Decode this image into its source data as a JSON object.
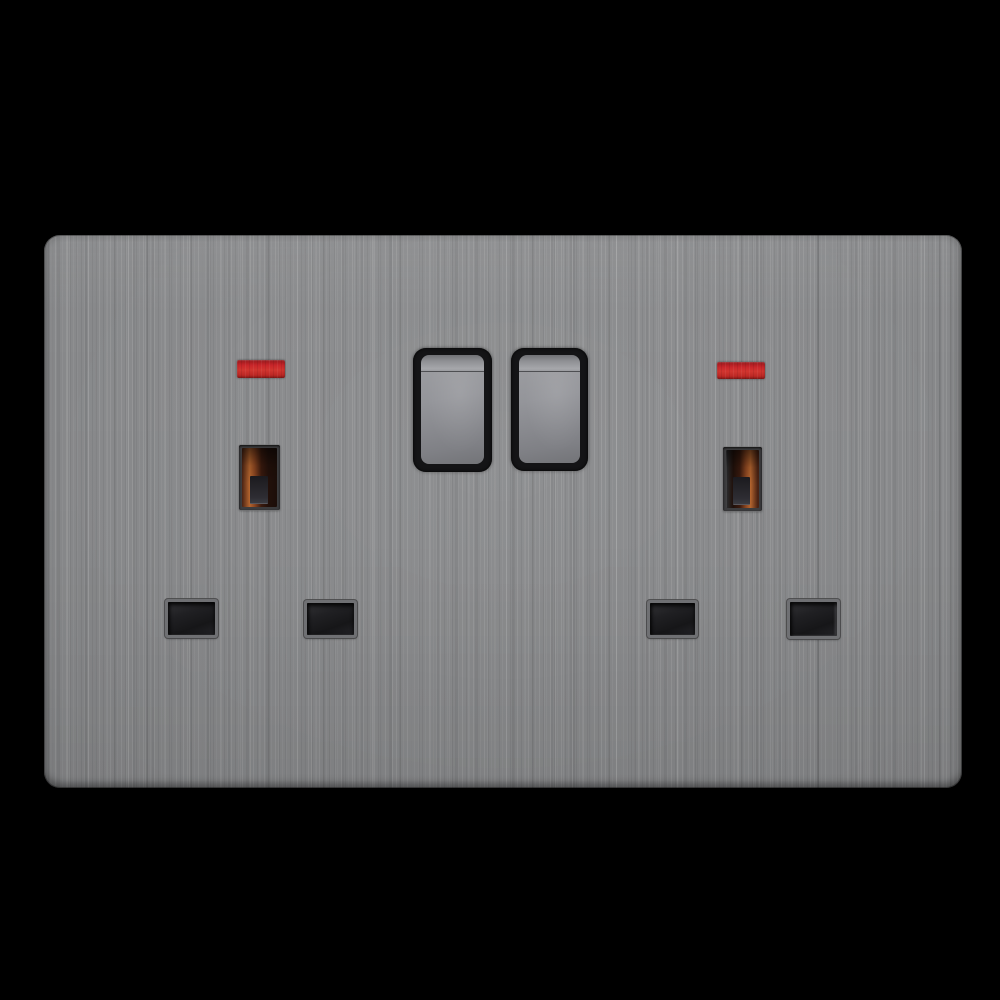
{
  "scene": {
    "type": "product-photo",
    "subject": "UK 13A double switched wall socket with neon indicators and brushed stainless steel screwless faceplate on black background",
    "visible_text": "none"
  },
  "colors": {
    "background": "#000000",
    "plate_base": "#8d8e90",
    "plate_streak_light": "#aaabad",
    "plate_streak_dark": "#77787a",
    "neon_red": "#c9262a",
    "neon_red_dark": "#97191c",
    "bezel_black": "#141416",
    "rocker_light": "#a6a7ab",
    "rocker_mid": "#909195",
    "rocker_dark": "#737478",
    "glow_orange": "#b4652f",
    "shutter_gray": "#2e2d33",
    "hole_frame": "#6f7073",
    "hole_cavity": "#161618"
  },
  "components": {
    "faceplate": {
      "name": "double-socket-faceplate",
      "finish": "brushed-steel",
      "corner_style": "rounded"
    },
    "switches": [
      {
        "name": "rocker-switch-left",
        "position": "up",
        "material": "metallic-gray"
      },
      {
        "name": "rocker-switch-right",
        "position": "up",
        "material": "metallic-gray"
      }
    ],
    "sockets": [
      {
        "name": "socket-left",
        "neon_indicator": "red",
        "earth_slot_glow_side": "left",
        "pin_holes": 3
      },
      {
        "name": "socket-right",
        "neon_indicator": "red",
        "earth_slot_glow_side": "right",
        "pin_holes": 3
      }
    ]
  }
}
